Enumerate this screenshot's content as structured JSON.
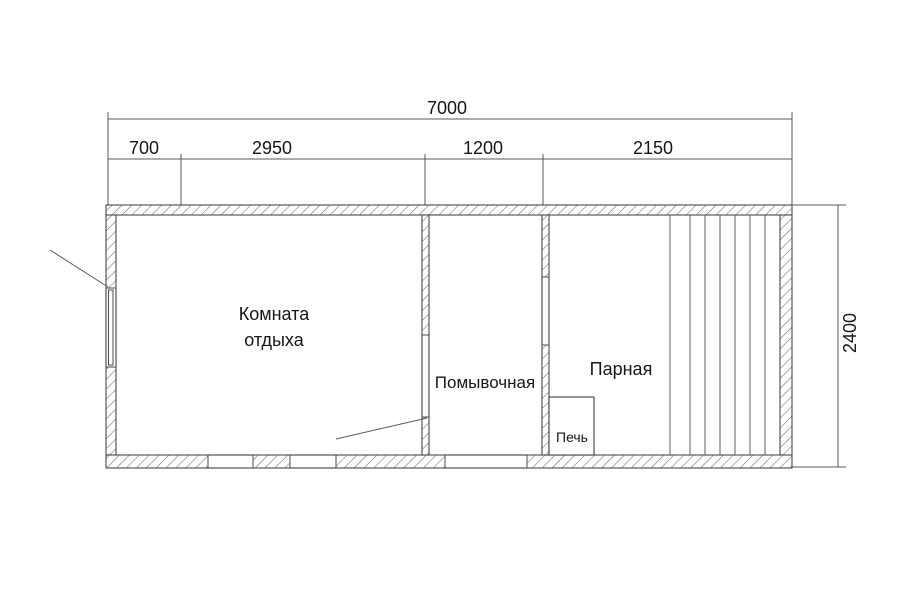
{
  "plan": {
    "dimensions": {
      "total_width": "7000",
      "overall_height": "2400",
      "segments": [
        "700",
        "2950",
        "1200",
        "2150"
      ]
    },
    "rooms": {
      "rest_room_line1": "Комната",
      "rest_room_line2": "отдыха",
      "washing_room": "Помывочная",
      "steam_room": "Парная",
      "stove": "Печь"
    },
    "colors": {
      "background": "#ffffff",
      "wall_line": "#3f3f3f",
      "hatch_line": "#6a6a6a",
      "dimension_line": "#5a5a5a",
      "text": "#161616"
    }
  }
}
